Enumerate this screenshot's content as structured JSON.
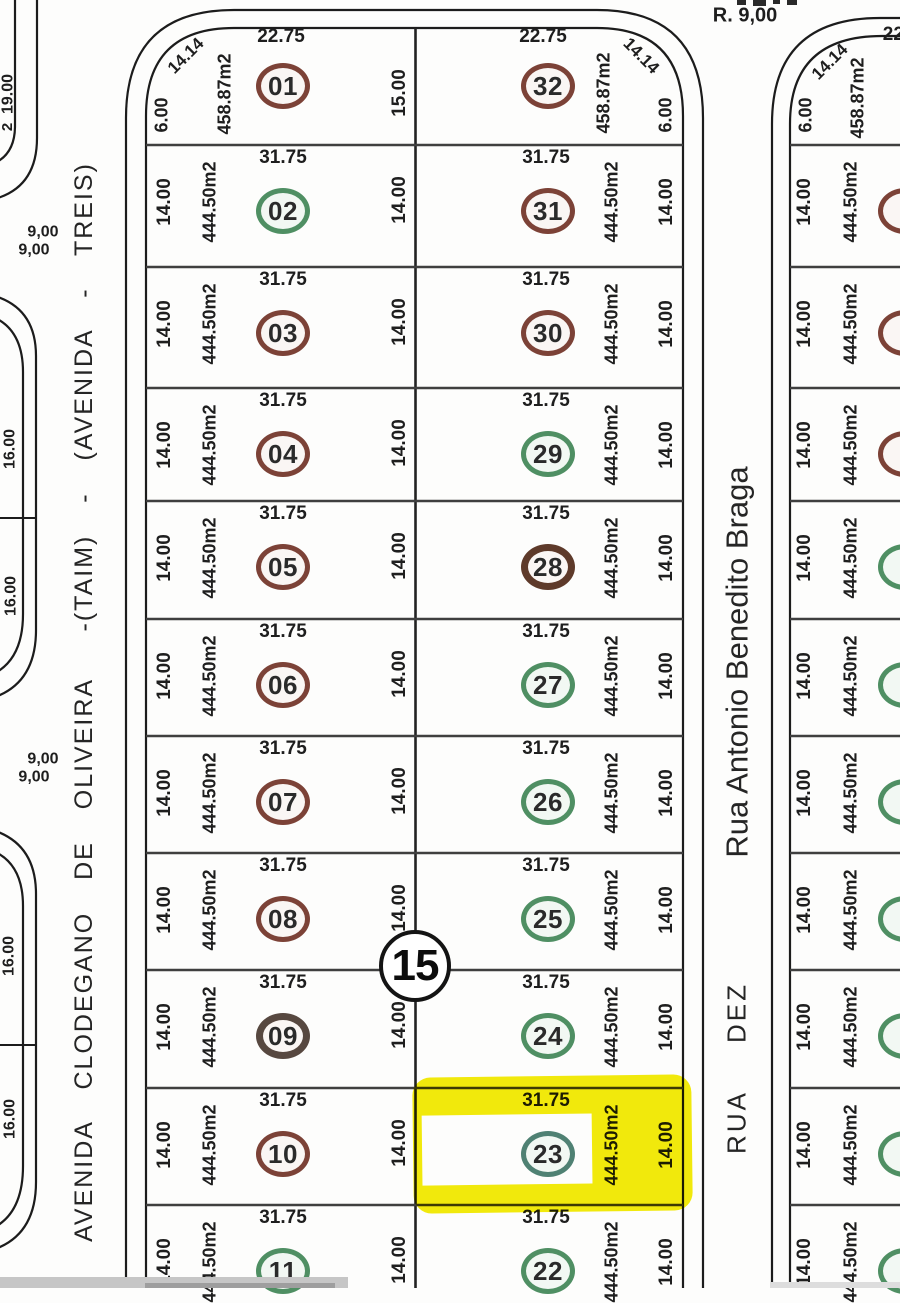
{
  "streets": {
    "top": "R. 9,00",
    "left": "AVENIDA  CLODEGANO  DE  OLIVEIRA   -(TAIM)  -  (AVENIDA  -  TREIS)",
    "right_name": "Rua Antonio Benedito Braga",
    "right_number": "RUA  DEZ"
  },
  "block": {
    "number": "15"
  },
  "highlight": {
    "lot": "23",
    "color": "#f3eb0c"
  },
  "colors": {
    "ring_brown": "#7c4237",
    "ring_green": "#4f8f63",
    "ring_dark_gray": "#574840",
    "ring_dark_brown": "#5e3a2a",
    "ring_teal": "#4f8173",
    "line": "#1c1c1c",
    "grid": "#3f3f3f"
  },
  "lots": [
    {
      "number": "01",
      "col": "left",
      "row": 0,
      "front": "22.75",
      "area": "458.87m2",
      "side_w": "6.00",
      "side_e": "15.00",
      "diag": "14.14",
      "ring": "#7c4237",
      "bw": 5
    },
    {
      "number": "02",
      "col": "left",
      "row": 1,
      "front": "31.75",
      "area": "444.50m2",
      "side_w": "14.00",
      "side_e": "14.00",
      "ring": "#4f8f63",
      "bw": 5
    },
    {
      "number": "03",
      "col": "left",
      "row": 2,
      "front": "31.75",
      "area": "444.50m2",
      "side_w": "14.00",
      "side_e": "14.00",
      "ring": "#7c4237",
      "bw": 5
    },
    {
      "number": "04",
      "col": "left",
      "row": 3,
      "front": "31.75",
      "area": "444.50m2",
      "side_w": "14.00",
      "side_e": "14.00",
      "ring": "#7c4237",
      "bw": 5
    },
    {
      "number": "05",
      "col": "left",
      "row": 4,
      "front": "31.75",
      "area": "444.50m2",
      "side_w": "14.00",
      "side_e": "14.00",
      "ring": "#7c4237",
      "bw": 5
    },
    {
      "number": "06",
      "col": "left",
      "row": 5,
      "front": "31.75",
      "area": "444.50m2",
      "side_w": "14.00",
      "side_e": "14.00",
      "ring": "#7c4237",
      "bw": 5
    },
    {
      "number": "07",
      "col": "left",
      "row": 6,
      "front": "31.75",
      "area": "444.50m2",
      "side_w": "14.00",
      "side_e": "14.00",
      "ring": "#7c4237",
      "bw": 5
    },
    {
      "number": "08",
      "col": "left",
      "row": 7,
      "front": "31.75",
      "area": "444.50m2",
      "side_w": "14.00",
      "side_e": "14.00",
      "ring": "#7c4237",
      "bw": 5
    },
    {
      "number": "09",
      "col": "left",
      "row": 8,
      "front": "31.75",
      "area": "444.50m2",
      "side_w": "14.00",
      "side_e": "14.00",
      "ring": "#574840",
      "bw": 7
    },
    {
      "number": "10",
      "col": "left",
      "row": 9,
      "front": "31.75",
      "area": "444.50m2",
      "side_w": "14.00",
      "side_e": "14.00",
      "ring": "#7c4237",
      "bw": 5
    },
    {
      "number": "11",
      "col": "left",
      "row": 10,
      "front": "31.75",
      "area": "444.50m2",
      "side_w": "14.00",
      "side_e": "14.00",
      "ring": "#4f8f63",
      "bw": 5
    },
    {
      "number": "32",
      "col": "right",
      "row": 0,
      "front": "22.75",
      "area": "458.87m2",
      "side_e": "6.00",
      "diag": "14.14",
      "ring": "#7c4237",
      "bw": 5
    },
    {
      "number": "31",
      "col": "right",
      "row": 1,
      "front": "31.75",
      "area": "444.50m2",
      "side_e": "14.00",
      "ring": "#7c4237",
      "bw": 5
    },
    {
      "number": "30",
      "col": "right",
      "row": 2,
      "front": "31.75",
      "area": "444.50m2",
      "side_e": "14.00",
      "ring": "#7c4237",
      "bw": 5
    },
    {
      "number": "29",
      "col": "right",
      "row": 3,
      "front": "31.75",
      "area": "444.50m2",
      "side_e": "14.00",
      "ring": "#4f8f63",
      "bw": 5
    },
    {
      "number": "28",
      "col": "right",
      "row": 4,
      "front": "31.75",
      "area": "444.50m2",
      "side_e": "14.00",
      "ring": "#5e3a2a",
      "bw": 7
    },
    {
      "number": "27",
      "col": "right",
      "row": 5,
      "front": "31.75",
      "area": "444.50m2",
      "side_e": "14.00",
      "ring": "#4f8f63",
      "bw": 5
    },
    {
      "number": "26",
      "col": "right",
      "row": 6,
      "front": "31.75",
      "area": "444.50m2",
      "side_e": "14.00",
      "ring": "#4f8f63",
      "bw": 5
    },
    {
      "number": "25",
      "col": "right",
      "row": 7,
      "front": "31.75",
      "area": "444.50m2",
      "side_e": "14.00",
      "ring": "#4f8f63",
      "bw": 5
    },
    {
      "number": "24",
      "col": "right",
      "row": 8,
      "front": "31.75",
      "area": "444.50m2",
      "side_e": "14.00",
      "ring": "#4f8f63",
      "bw": 5
    },
    {
      "number": "23",
      "col": "right",
      "row": 9,
      "front": "31.75",
      "area": "444.50m2",
      "side_e": "14.00",
      "ring": "#4f8173",
      "bw": 5
    },
    {
      "number": "22",
      "col": "right",
      "row": 10,
      "front": "31.75",
      "area": "444.50m2",
      "side_e": "14.00",
      "ring": "#4f8f63",
      "bw": 5
    },
    {
      "number": "",
      "col": "far",
      "row": 0,
      "front": "22.",
      "area": "458.87m2",
      "side_w": "6.00",
      "diag": "14.14",
      "ring": "#7c4237",
      "bw": 5
    },
    {
      "number": "",
      "col": "far",
      "row": 1,
      "front": "",
      "area": "444.50m2",
      "side_w": "14.00",
      "ring": "#7c4237",
      "bw": 5
    },
    {
      "number": "",
      "col": "far",
      "row": 2,
      "front": "",
      "area": "444.50m2",
      "side_w": "14.00",
      "ring": "#7c4237",
      "bw": 5
    },
    {
      "number": "",
      "col": "far",
      "row": 3,
      "front": "",
      "area": "444.50m2",
      "side_w": "14.00",
      "ring": "#7c4237",
      "bw": 5
    },
    {
      "number": "",
      "col": "far",
      "row": 4,
      "front": "",
      "area": "444.50m2",
      "side_w": "14.00",
      "ring": "#4f8f63",
      "bw": 5
    },
    {
      "number": "",
      "col": "far",
      "row": 5,
      "front": "",
      "area": "444.50m2",
      "side_w": "14.00",
      "ring": "#4f8f63",
      "bw": 5
    },
    {
      "number": "",
      "col": "far",
      "row": 6,
      "front": "",
      "area": "444.50m2",
      "side_w": "14.00",
      "ring": "#4f8f63",
      "bw": 5
    },
    {
      "number": "",
      "col": "far",
      "row": 7,
      "front": "",
      "area": "444.50m2",
      "side_w": "14.00",
      "ring": "#4f8f63",
      "bw": 5
    },
    {
      "number": "",
      "col": "far",
      "row": 8,
      "front": "",
      "area": "444.50m2",
      "side_w": "14.00",
      "ring": "#4f8f63",
      "bw": 5
    },
    {
      "number": "",
      "col": "far",
      "row": 9,
      "front": "",
      "area": "444.50m2",
      "side_w": "14.00",
      "ring": "#4f8f63",
      "bw": 5
    },
    {
      "number": "",
      "col": "far",
      "row": 10,
      "front": "",
      "area": "444.50m2",
      "side_w": "14.00",
      "ring": "#4f8f63",
      "bw": 5
    }
  ],
  "annotations": [
    {
      "name": "dim-lot01-depth",
      "text": "15.00",
      "x": 400,
      "y": 93,
      "rot": -90,
      "size": 19
    },
    {
      "name": "dim-19-00",
      "text": "19.00",
      "x": 9,
      "y": 94,
      "rot": -90,
      "size": 16
    },
    {
      "name": "dim-2-partial",
      "text": "2",
      "x": 8,
      "y": 127,
      "rot": -90,
      "size": 15
    },
    {
      "name": "dim-9-00-a1",
      "text": "9,00",
      "x": 43,
      "y": 233,
      "rot": 0,
      "size": 16
    },
    {
      "name": "dim-9-00-a2",
      "text": "9,00",
      "x": 34,
      "y": 251,
      "rot": 0,
      "size": 16
    },
    {
      "name": "dim-9-00-b1",
      "text": "9,00",
      "x": 43,
      "y": 760,
      "rot": 0,
      "size": 16
    },
    {
      "name": "dim-9-00-b2",
      "text": "9,00",
      "x": 34,
      "y": 778,
      "rot": 0,
      "size": 16
    },
    {
      "name": "dim-16-00-1",
      "text": "16.00",
      "x": 11,
      "y": 449,
      "rot": -90,
      "size": 16
    },
    {
      "name": "dim-16-00-2",
      "text": "16.00",
      "x": 12,
      "y": 596,
      "rot": -90,
      "size": 16
    },
    {
      "name": "dim-16-00-3",
      "text": "16.00",
      "x": 10,
      "y": 956,
      "rot": -90,
      "size": 16
    },
    {
      "name": "dim-16-00-4",
      "text": "16.00",
      "x": 11,
      "y": 1119,
      "rot": -90,
      "size": 16
    }
  ]
}
